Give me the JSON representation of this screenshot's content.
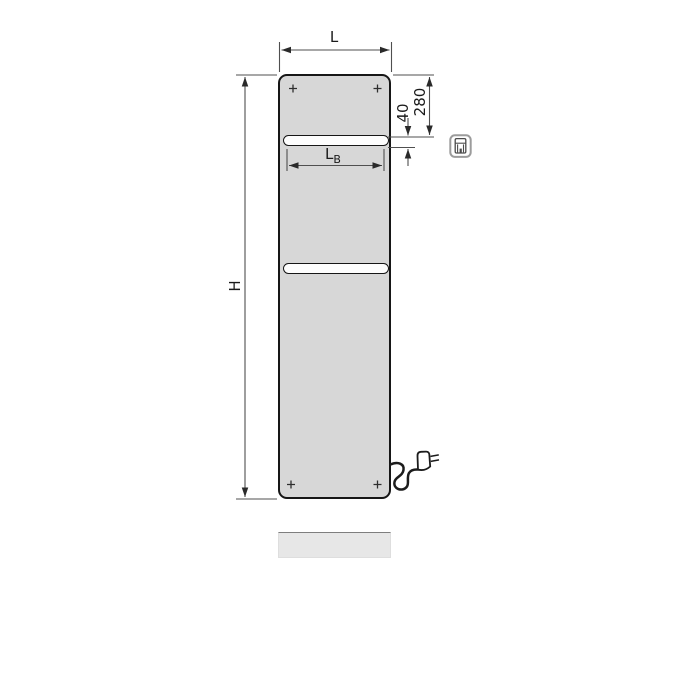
{
  "diagram": {
    "type": "technical-dimension-drawing",
    "subject": "flat-panel-electric-radiator-front-view",
    "labels": {
      "width": "L",
      "height": "H",
      "slot_offset_top": "280",
      "slot_height": "40",
      "inner_width_main": "L",
      "inner_width_sub": "B"
    },
    "icons": {
      "control_element": "electric-element-icon",
      "power": "power-plug-icon"
    },
    "colors": {
      "panel_fill": "#d7d7d7",
      "panel_outline": "#161616",
      "slot_fill": "#fdfdfd",
      "dimension_line": "#4f4f4f",
      "arrow_fill": "#2a2a2a",
      "shadow_fill": "#e7e7e7",
      "icon_border": "#9c9c9c"
    }
  }
}
